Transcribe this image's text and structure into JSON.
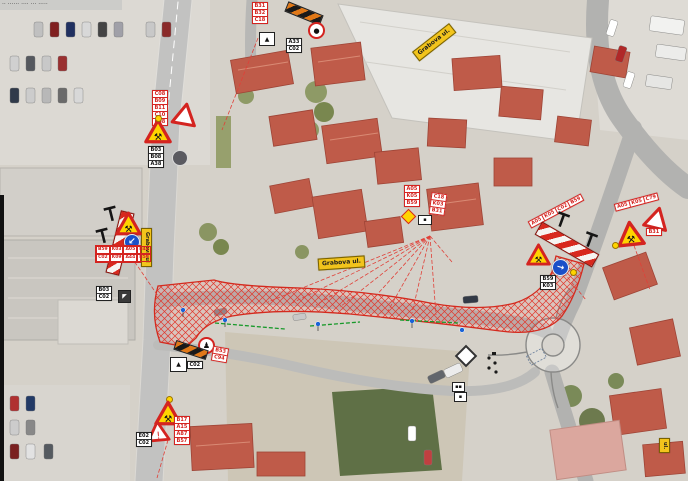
{
  "title_strip": {
    "text": "·· ······ ···· ··· ·····"
  },
  "street_labels": [
    {
      "label": "Grabova ul."
    },
    {
      "label": "Grabova ul."
    },
    {
      "label": "Grabova ul"
    },
    {
      "label": "ul."
    }
  ],
  "colors": {
    "work_zone_red": "#e0382c",
    "sign_code_red": "#d42420",
    "street_label_yellow": "#f2c41c",
    "barrier_red": "#d8281e",
    "mandatory_blue": "#1a50c8",
    "warning_yellow": "#ffd400",
    "corridor_green": "#18992a"
  },
  "signs": {
    "top_cluster": {
      "red_codes": [
        "B31",
        "B32",
        "C18"
      ],
      "white_codes": [
        "A33",
        "C02"
      ]
    },
    "upper_left_cluster": {
      "red_codes": [
        "C08",
        "B09",
        "B11",
        "C10",
        "C08"
      ],
      "white_codes": [
        "B03",
        "B08",
        "A38"
      ]
    },
    "left_barrier": {
      "red_codes": [
        "B59",
        "K03",
        "A05",
        "B44",
        "C02",
        "K09",
        "A44",
        "B59"
      ]
    },
    "center_cluster": {
      "red_codes": [
        "A05",
        "K05",
        "B59",
        "C18",
        "K03",
        "B31"
      ]
    },
    "right_barrier": {
      "red_codes": [
        "A05",
        "K05",
        "C02",
        "B59"
      ],
      "white_codes": [
        "B59",
        "K03"
      ]
    },
    "right_cluster": {
      "red_codes": [
        "A05",
        "K05",
        "C79",
        "B31"
      ]
    },
    "mid_left_cluster": {
      "red_codes": [
        "B53",
        "C94"
      ],
      "white_codes": [
        "C02"
      ]
    },
    "bottom_left_cluster": {
      "red_codes": [
        "B17",
        "A15",
        "A87",
        "B57"
      ],
      "white_codes": [
        "E02",
        "C02"
      ]
    },
    "road_edge_plates": {
      "white_codes": [
        "B03",
        "C02"
      ]
    }
  }
}
